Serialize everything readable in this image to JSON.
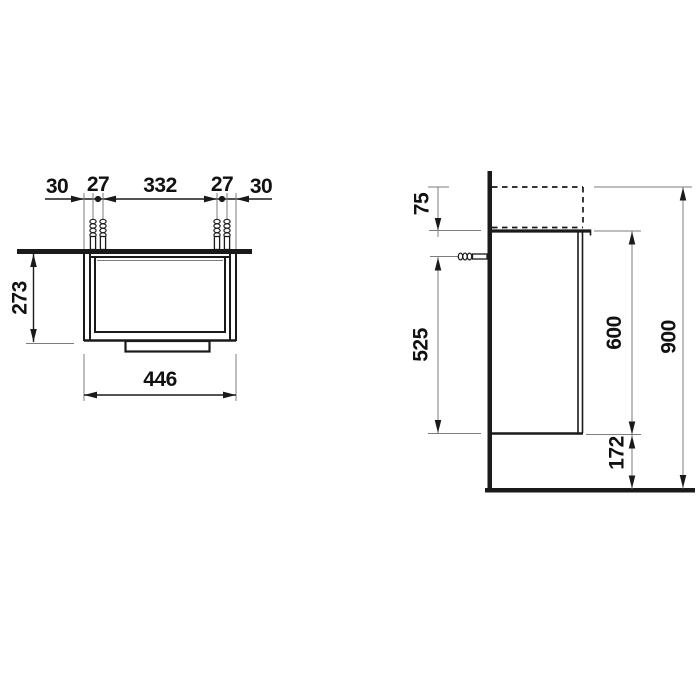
{
  "page": {
    "background": "#ffffff"
  },
  "colors": {
    "ink": "#1a1a1a",
    "thin_line": "#7d7d7d"
  },
  "plan_view": {
    "top_chain": {
      "left_offset": "30",
      "left_pair_gap": "27",
      "center_span": "332",
      "right_pair_gap": "27",
      "right_offset": "30"
    },
    "depth": "273",
    "width": "446"
  },
  "side_view": {
    "top_overhang": "75",
    "anchor_height": "525",
    "cabinet_height": "600",
    "total_height": "900",
    "bottom_clearance": "172"
  }
}
